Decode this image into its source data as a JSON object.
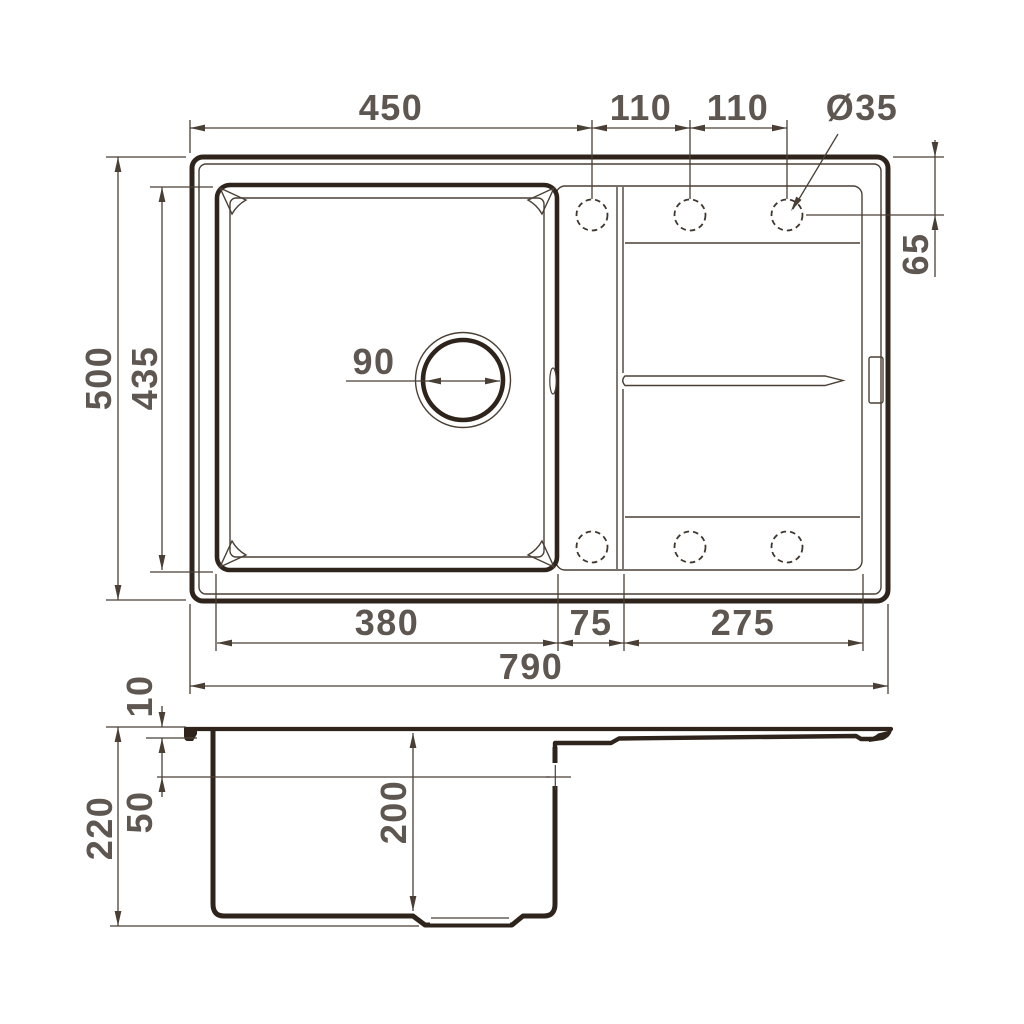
{
  "colors": {
    "ink": "#2f241b",
    "dim_line": "#4a3f35",
    "label": "#5e5650",
    "background": "#ffffff"
  },
  "top_view": {
    "labels": {
      "basin_outer_width": "450",
      "hole_spacing_1": "110",
      "hole_spacing_2": "110",
      "faucet_hole_diameter": "Ø35",
      "hole_edge_offset": "65",
      "overall_depth": "500",
      "basin_depth": "435",
      "drain_diameter": "90",
      "basin_inner_width": "380",
      "ledge_width": "75",
      "drainboard_width": "275",
      "overall_width": "790"
    }
  },
  "side_view": {
    "labels": {
      "rim_lip_height": "10",
      "ledge_drop": "50",
      "bowl_depth": "200",
      "overall_height": "220"
    }
  }
}
